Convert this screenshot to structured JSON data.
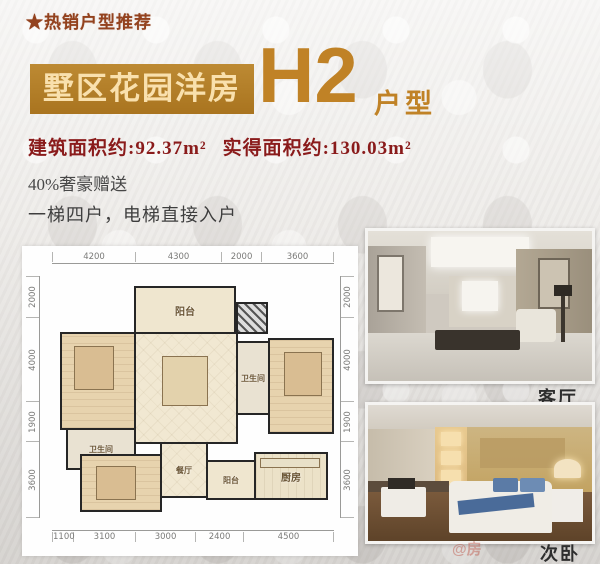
{
  "header": {
    "tagline": "★热销户型推荐",
    "banner": "墅区花园洋房",
    "unit_code": "H2",
    "unit_suffix": "户型",
    "area_built": "建筑面积约:92.37m²",
    "area_actual": "实得面积约:130.03m²",
    "gift_line": "40%奢豪赠送",
    "elevator_line": "一梯四户，电梯直接入户"
  },
  "colors": {
    "accent_gold": "#b5802d",
    "banner_text": "#f9e0ad",
    "title_gold": "#c08226",
    "area_red": "#8a1b1b",
    "tagline_red": "#93421e",
    "body_text": "#3e3e3e"
  },
  "floorplan": {
    "dims_top": [
      "4200",
      "4300",
      "2000",
      "3600"
    ],
    "dims_bottom": [
      "1100",
      "3100",
      "3000",
      "2400",
      "4500"
    ],
    "dims_left": [
      "2000",
      "4000",
      "1900",
      "3600"
    ],
    "dims_right": [
      "2000",
      "4000",
      "1900",
      "3600"
    ],
    "rooms": {
      "balcony_top": "阳台",
      "master_bedroom": "主卧室",
      "living": "客厅",
      "bath_center": "卫生间",
      "second_master": "次主卧室",
      "bath_left": "卫生间",
      "bedroom": "卧室",
      "dining": "餐厅",
      "balcony_bottom": "阳台",
      "kitchen": "厨房"
    }
  },
  "photos": {
    "living_label": "客厅",
    "bedroom_label": "次卧"
  },
  "watermark": "@房"
}
